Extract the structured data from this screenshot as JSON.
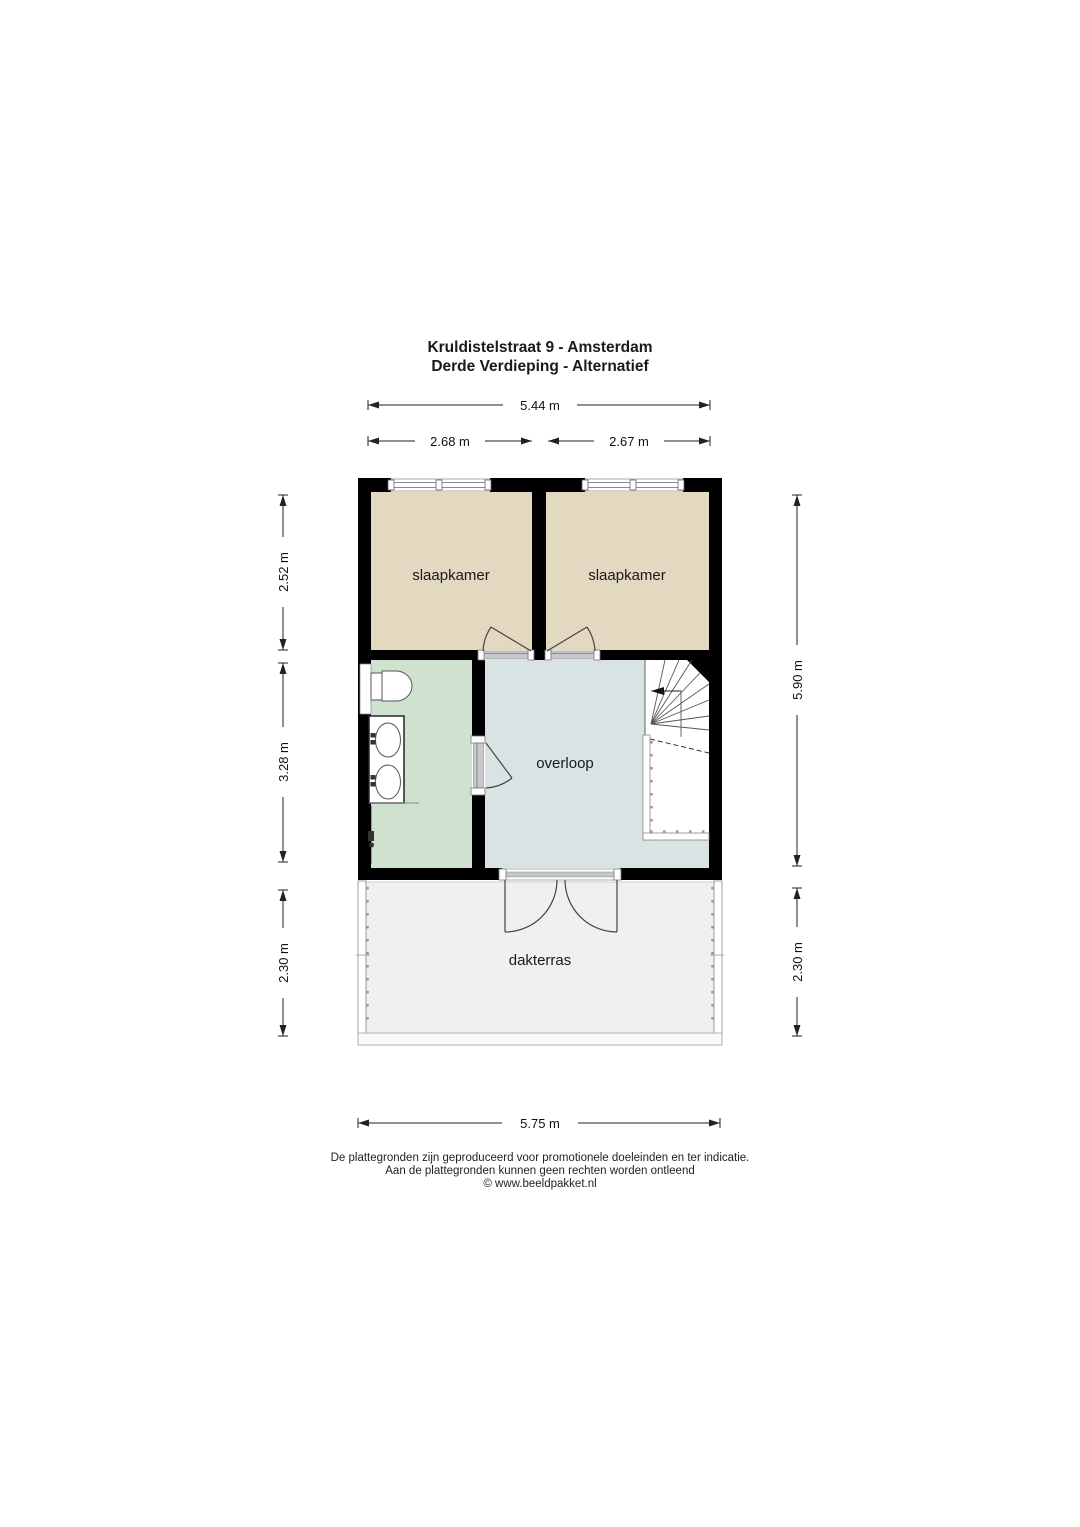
{
  "title": {
    "line1": "Kruldistelstraat 9 - Amsterdam",
    "line2": "Derde Verdieping - Alternatief"
  },
  "rooms": {
    "bedroom_left": {
      "label": "slaapkamer"
    },
    "bedroom_right": {
      "label": "slaapkamer"
    },
    "landing": {
      "label": "overloop"
    },
    "roof_terrace": {
      "label": "dakterras"
    }
  },
  "dimensions": {
    "top_total": "5.44 m",
    "top_left_room": "2.68 m",
    "top_right_room": "2.67 m",
    "left_bedrooms": "2.52 m",
    "left_middle": "3.28 m",
    "left_terrace": "2.30 m",
    "right_upper": "5.90 m",
    "right_terrace": "2.30 m",
    "bottom_total": "5.75 m"
  },
  "footer": {
    "line1": "De plattegronden zijn geproduceerd voor promotionele doeleinden en ter indicatie.",
    "line2": "Aan de plattegronden kunnen geen rechten worden ontleend",
    "line3": "© www.beeldpakket.nl"
  },
  "colors": {
    "wall": "#000000",
    "bedroom_floor": "#e3d9c1",
    "bathroom_floor": "#cfe2d0",
    "landing_floor": "#d9e3e4",
    "terrace_floor": "#f0f0f0",
    "stairs_floor": "#ffffff"
  }
}
